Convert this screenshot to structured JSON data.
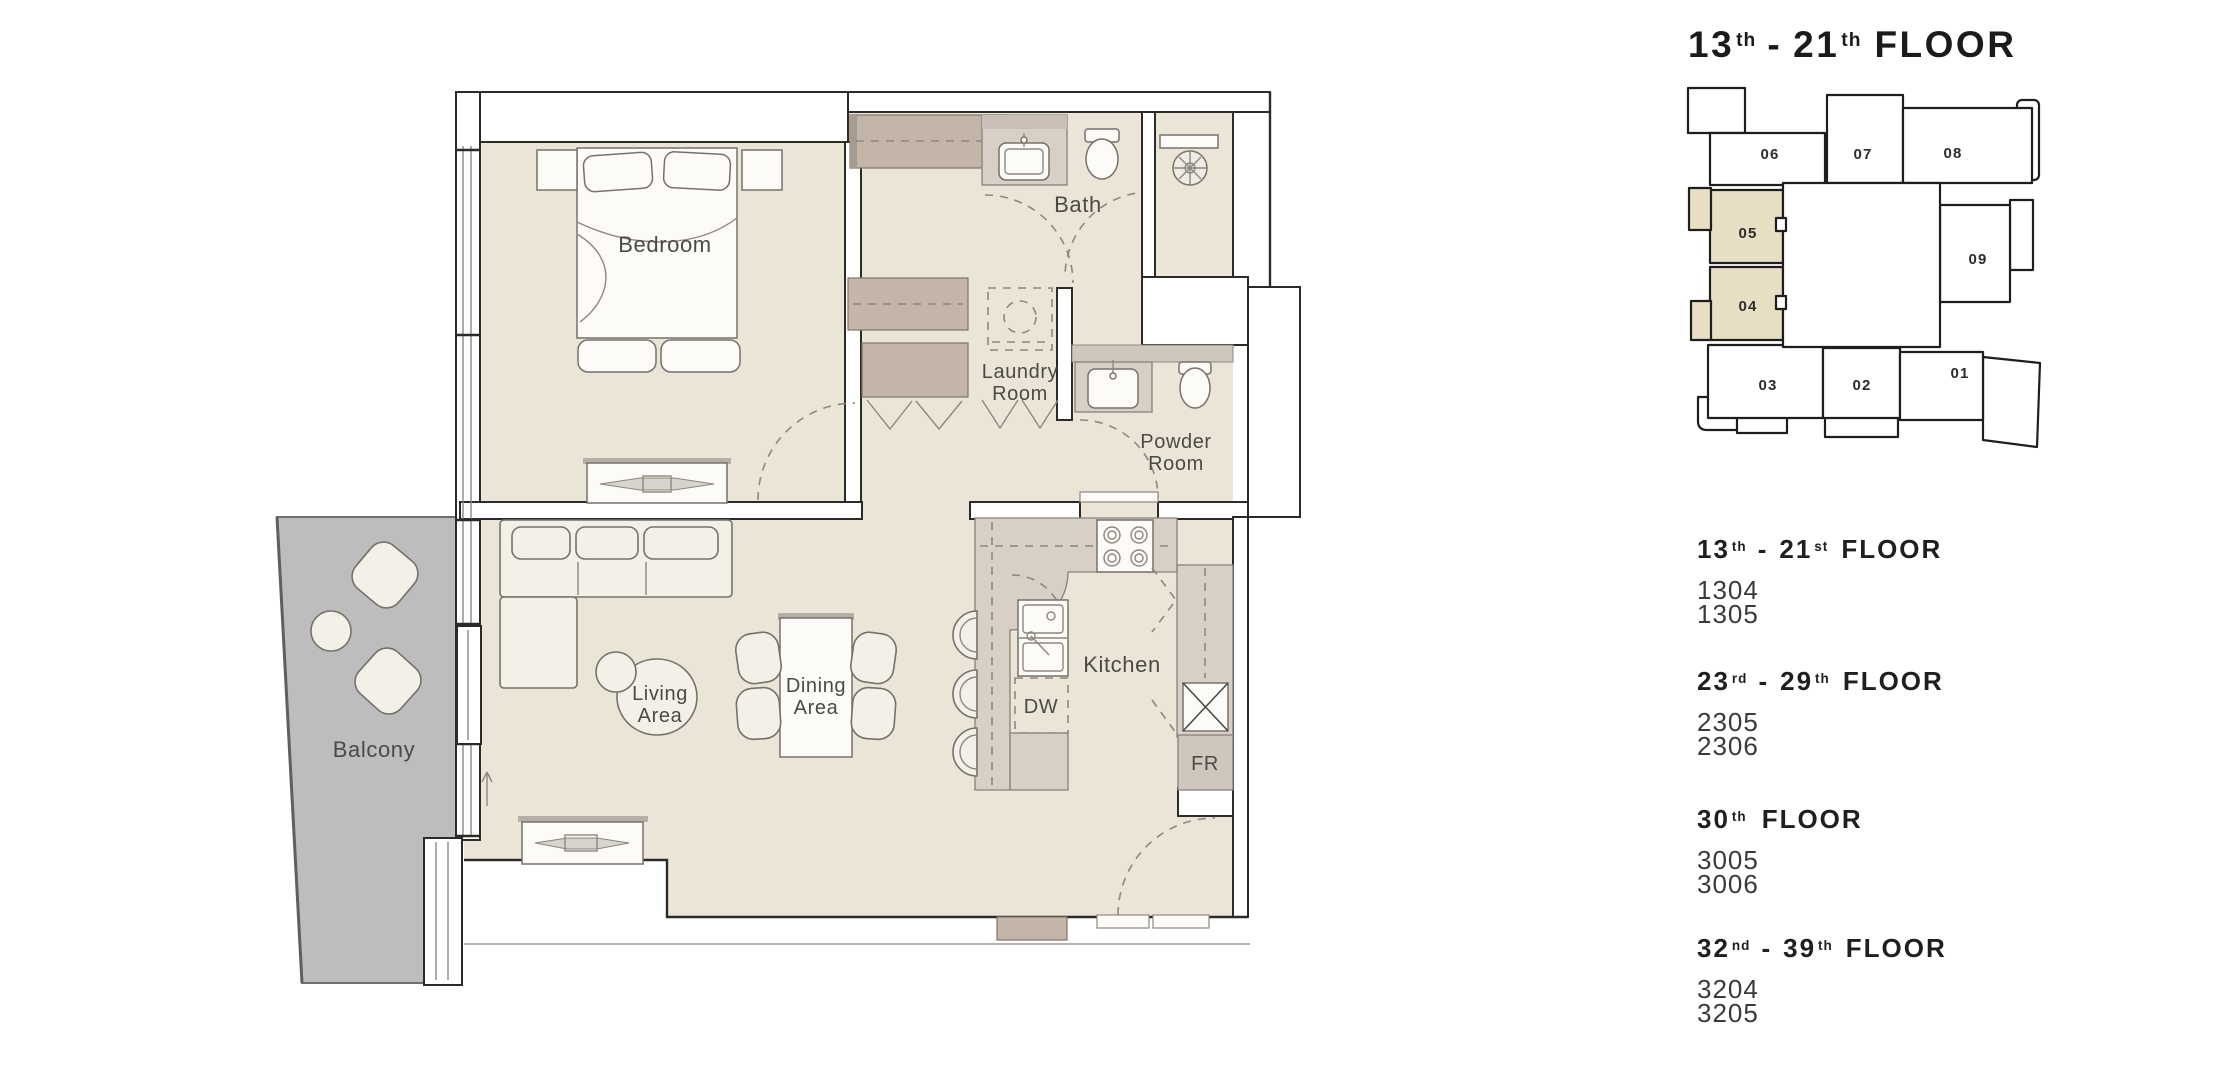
{
  "key_plan": {
    "title": {
      "n1": "13",
      "s1": "th",
      "dash": "-",
      "n2": "21",
      "s2": "th",
      "word": "FLOOR"
    },
    "units": [
      {
        "id": "01",
        "highlighted": false
      },
      {
        "id": "02",
        "highlighted": false
      },
      {
        "id": "03",
        "highlighted": false
      },
      {
        "id": "04",
        "highlighted": true
      },
      {
        "id": "05",
        "highlighted": true
      },
      {
        "id": "06",
        "highlighted": false
      },
      {
        "id": "07",
        "highlighted": false
      },
      {
        "id": "08",
        "highlighted": false
      },
      {
        "id": "09",
        "highlighted": false
      }
    ],
    "highlight_color": "#e8dec3"
  },
  "plan_labels": {
    "bedroom": "Bedroom",
    "bath": "Bath",
    "laundry_1": "Laundry",
    "laundry_2": "Room",
    "powder_1": "Powder",
    "powder_2": "Room",
    "living_1": "Living",
    "living_2": "Area",
    "dining_1": "Dining",
    "dining_2": "Area",
    "kitchen": "Kitchen",
    "dw": "DW",
    "fr": "FR",
    "balcony": "Balcony"
  },
  "listings": [
    {
      "n1": "13",
      "s1": "th",
      "dash": "-",
      "n2": "21",
      "s2": "st",
      "word": "FLOOR",
      "units": [
        "1304",
        "1305"
      ]
    },
    {
      "n1": "23",
      "s1": "rd",
      "dash": "-",
      "n2": "29",
      "s2": "th",
      "word": "FLOOR",
      "units": [
        "2305",
        "2306"
      ]
    },
    {
      "n1": "30",
      "s1": "th",
      "dash": "",
      "n2": "",
      "s2": "",
      "word": "FLOOR",
      "units": [
        "3005",
        "3006"
      ]
    },
    {
      "n1": "32",
      "s1": "nd",
      "dash": "-",
      "n2": "39",
      "s2": "th",
      "word": "FLOOR",
      "units": [
        "3204",
        "3205"
      ]
    }
  ],
  "colors": {
    "floor": "#ebe5d8",
    "balcony": "#bdbdbd",
    "closet": "#c3b5a8",
    "counter": "#d8d0c7",
    "keyplan_highlight": "#e8dec3",
    "wall_line": "#2d2b28"
  }
}
